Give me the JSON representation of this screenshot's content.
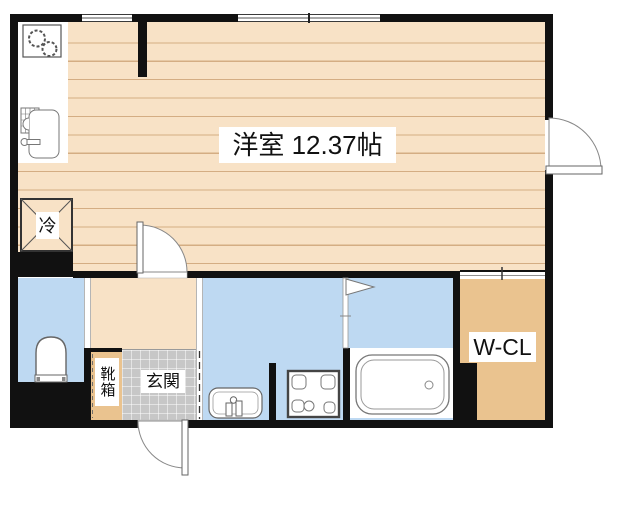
{
  "floorplan": {
    "labels": {
      "main_room": "洋室 12.37帖",
      "refrigerator": "冷",
      "shoe_box": "靴箱",
      "entrance": "玄関",
      "walk_in_closet": "W-CL"
    },
    "colors": {
      "wall": "#111111",
      "wood_floor": "#f8e2c6",
      "wood_floor_line": "#d4ad83",
      "closet_tan": "#eac38f",
      "wet_area_blue": "#bed9f2",
      "entrance_tile_gray": "#c7c7c7",
      "fixture_outline": "#777777"
    },
    "icons": [
      "stove-icon",
      "kitchen-sink-icon",
      "refrigerator-cross-icon",
      "toilet-icon",
      "washbasin-icon",
      "washing-machine-pan-icon",
      "bathtub-icon",
      "shower-icon",
      "window-icon",
      "room-door-swing-icon",
      "entry-door-swing-icon",
      "balcony-door-swing-icon",
      "folding-door-icon"
    ]
  }
}
